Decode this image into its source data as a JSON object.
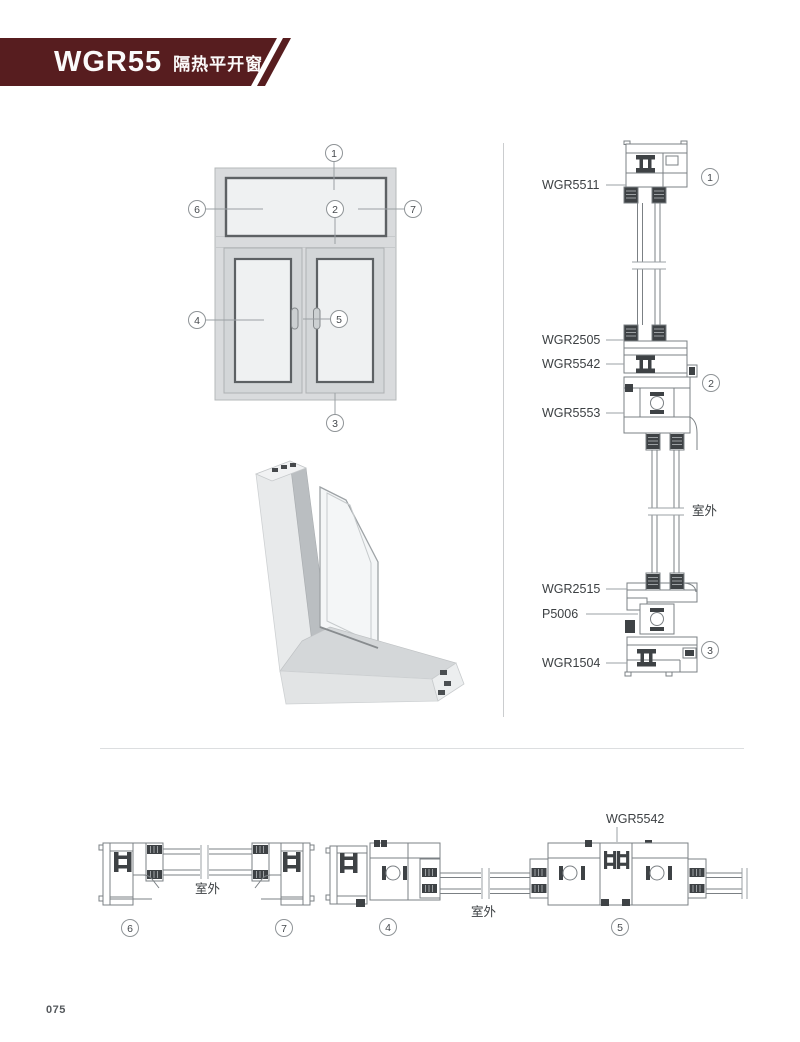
{
  "header": {
    "series": "WGR55",
    "subtitle": "隔热平开窗"
  },
  "elevation": {
    "callouts": [
      "1",
      "2",
      "3",
      "4",
      "5",
      "6",
      "7"
    ]
  },
  "vertical_section": {
    "parts": [
      "WGR5511",
      "WGR2505",
      "WGR5542",
      "WGR5553",
      "WGR2515",
      "P5006",
      "WGR1504"
    ],
    "callouts": [
      "1",
      "2",
      "3"
    ],
    "outdoor_label": "室外"
  },
  "bottom_sections": {
    "fixed": {
      "callouts": [
        "6",
        "7"
      ],
      "outdoor_label": "室外"
    },
    "casement": {
      "callouts": [
        "4",
        "5"
      ],
      "outdoor_label": "室外",
      "part_label": "WGR5542"
    }
  },
  "footer": {
    "page_number": "075"
  },
  "palette": {
    "banner": "#571d1f",
    "line": "#7b8084",
    "dark": "#3e4245",
    "frame_fill": "#d9dbdd",
    "glass_fill": "#eff1f2",
    "pane_stroke": "#5d6164"
  }
}
